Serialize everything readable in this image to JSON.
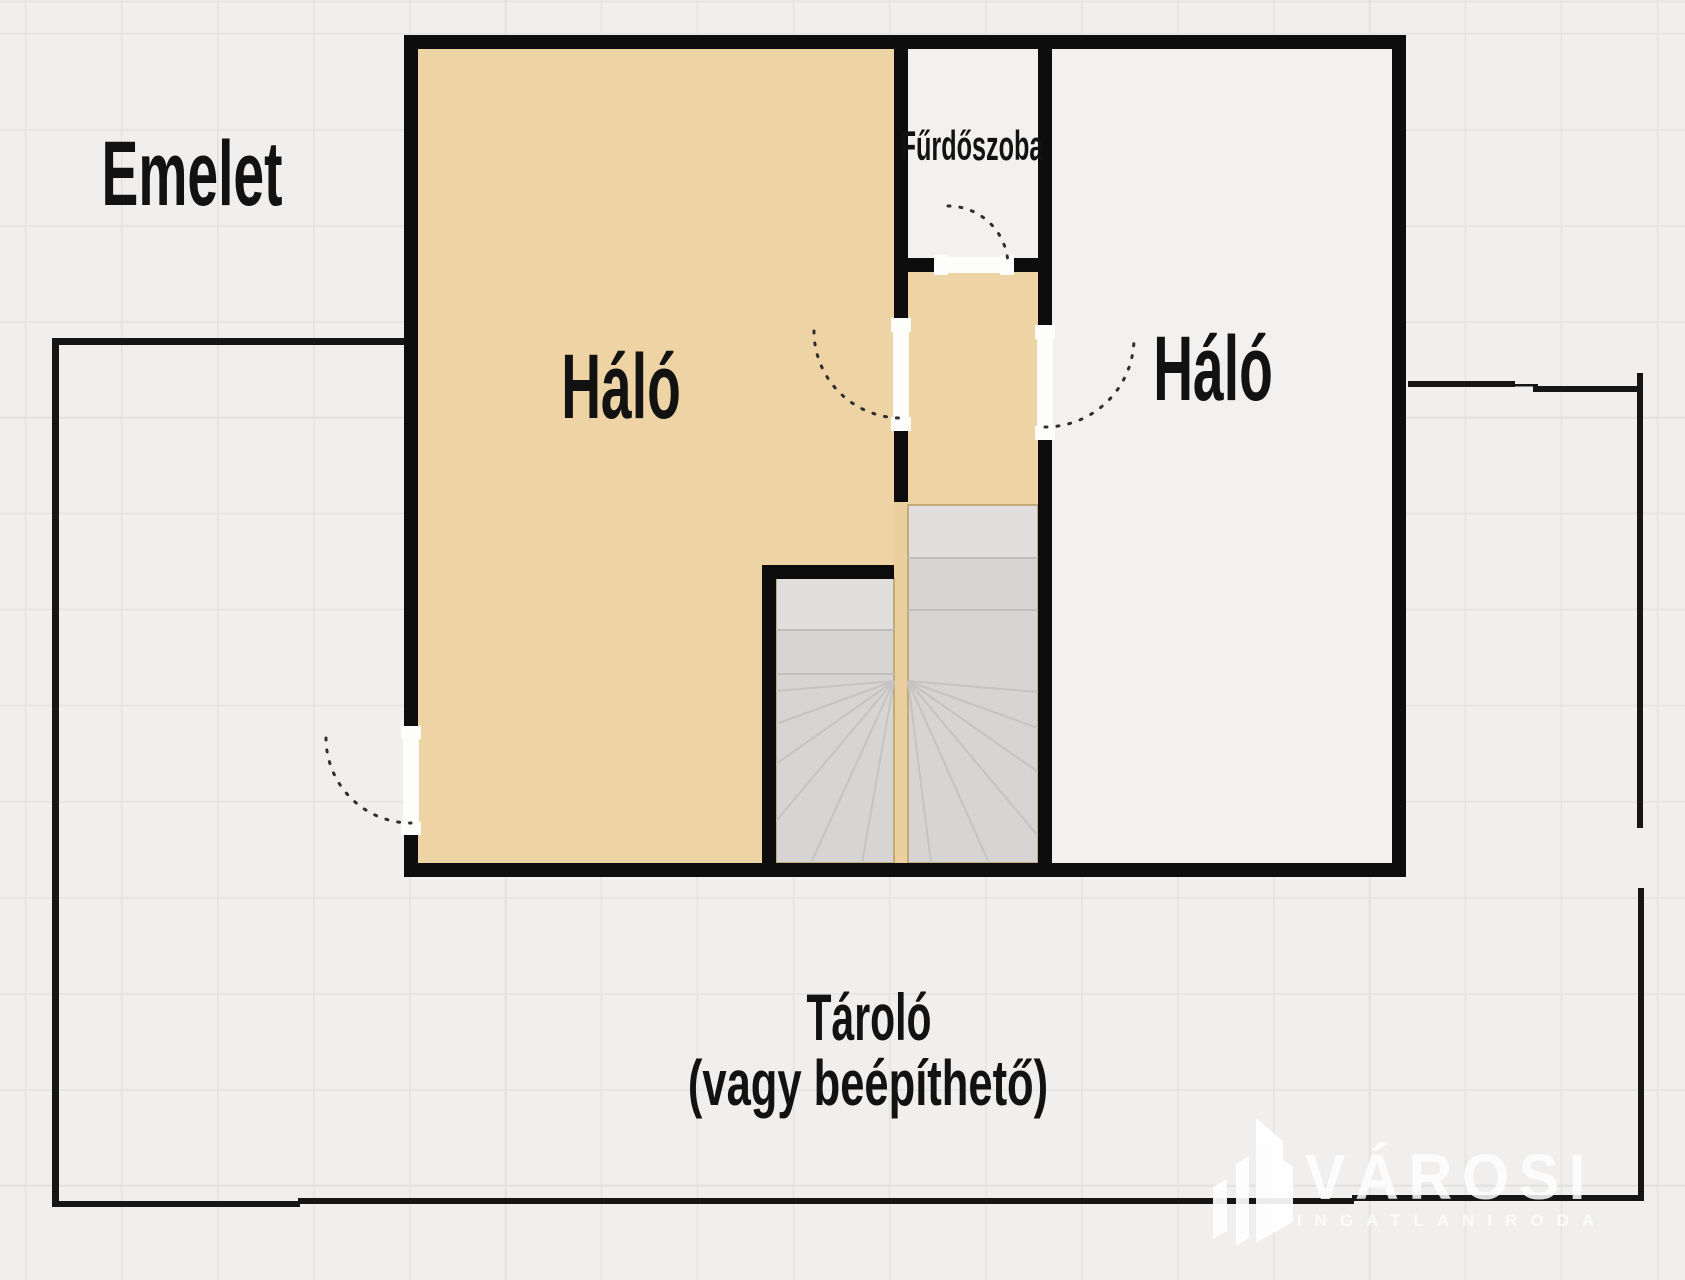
{
  "floor_plan": {
    "floor_label": "Emelet",
    "rooms": {
      "bedroom_left": {
        "label": "Háló"
      },
      "bedroom_right": {
        "label": "Háló"
      },
      "bathroom": {
        "label": "Fűrdőszoba"
      },
      "storage": {
        "label": "Tároló",
        "sublabel": "(vagy beépíthető)"
      }
    },
    "features": [
      "door-swing-arc",
      "winder-staircase",
      "storage-boundary",
      "terrace-boundary"
    ]
  },
  "watermark": {
    "brand": "VÁROSI",
    "tagline": "INGATLANIRODA",
    "logo_icon": "buildings-icon"
  },
  "colors": {
    "background": "#f0efed",
    "grid_line": "#e3e2e0",
    "wall": "#0d0d0d",
    "thin_line": "#161616",
    "floor_tan": "#eed3a4",
    "divider_tan": "#ebcf9e",
    "room_white": "#f2f1ef",
    "stair_base": "#d6d5d3",
    "stair_landing": "#e0dfdd",
    "stair_line": "#bfbebc",
    "stair_ray": "#c5c4c2",
    "stair_edge": "#b99c66",
    "door_gap": "#fdfdfc",
    "arc": "#2e2e2e",
    "label_text": "#121212",
    "watermark_white": "#ffffff"
  }
}
